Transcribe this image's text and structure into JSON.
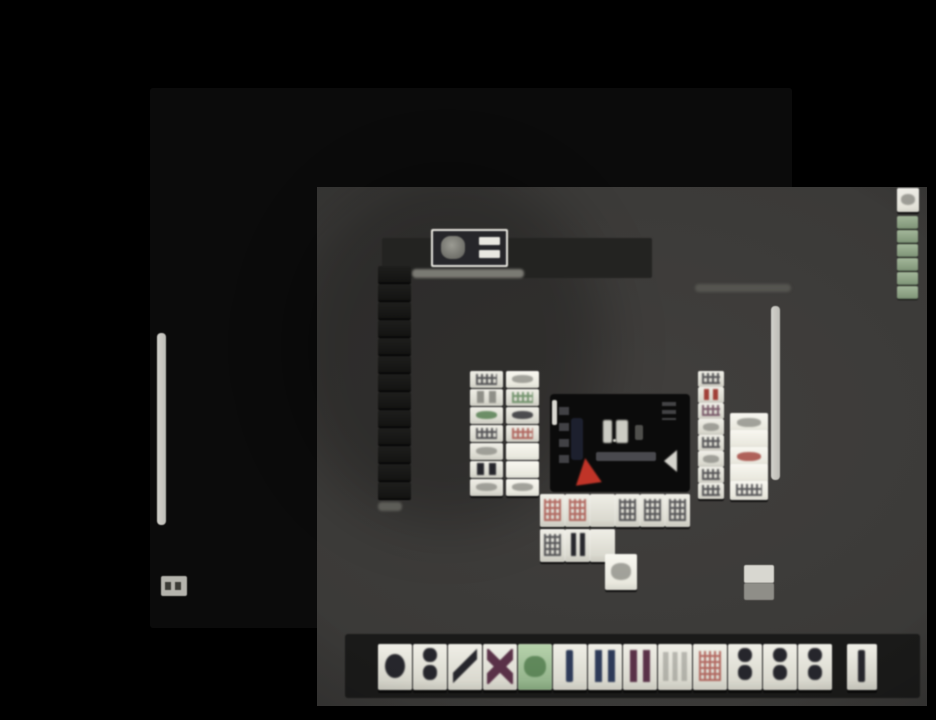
{
  "palette": {
    "black": "#000000",
    "frame": "#0b0b0b",
    "table": "#3b3a38",
    "band": "#232321",
    "white_ui": "#d9d8d1",
    "scrollbar": "#c9c8c2",
    "caption_smudge": "#98978f",
    "info_smudge": "#5c5c56",
    "red_marker": "#c03428",
    "glyph_dark": "#26262c",
    "glyph_gray": "#8f8f88",
    "glyph_red": "#a03f38",
    "glyph_green": "#4f7a4b",
    "glyph_navy": "#2d3a58",
    "glyph_maroon": "#5a3148",
    "green_tile_face": "#a4c49a",
    "wall_tile_back": "#161614"
  },
  "board": {
    "hand": {
      "tiles": [
        {
          "glyph": "circle",
          "color": "glyph_dark"
        },
        {
          "glyph": "dots2",
          "color": "glyph_dark"
        },
        {
          "glyph": "diag",
          "color": "glyph_dark"
        },
        {
          "glyph": "cross",
          "color": "glyph_maroon"
        },
        {
          "face": "green",
          "glyph": "smudge",
          "color": "glyph_green"
        },
        {
          "glyph": "bar",
          "color": "glyph_navy"
        },
        {
          "glyph": "bars2",
          "color": "glyph_navy"
        },
        {
          "glyph": "bars2",
          "color": "glyph_maroon"
        },
        {
          "glyph": "bars3",
          "color": "glyph_gray"
        },
        {
          "glyph": "cluster",
          "color": "glyph_red"
        },
        {
          "glyph": "dots2",
          "color": "glyph_dark"
        },
        {
          "glyph": "dots2",
          "color": "glyph_dark"
        },
        {
          "glyph": "dots2",
          "color": "glyph_dark"
        }
      ],
      "drawn": [
        {
          "glyph": "bar",
          "color": "glyph_dark"
        }
      ]
    },
    "discards": {
      "left_col_a": [
        {
          "glyph": "cluster",
          "color": "glyph_dark"
        },
        {
          "glyph": "bars2",
          "color": "glyph_gray"
        },
        {
          "glyph": "smudge",
          "color": "glyph_green"
        },
        {
          "glyph": "cluster",
          "color": "glyph_dark"
        },
        {
          "glyph": "smudge",
          "color": "glyph_gray"
        },
        {
          "glyph": "bars2",
          "color": "glyph_dark"
        },
        {
          "glyph": "smudge",
          "color": "glyph_gray"
        }
      ],
      "left_col_b": [
        {
          "face": "bright",
          "glyph": "smudge",
          "color": "glyph_gray"
        },
        {
          "glyph": "cluster",
          "color": "glyph_green"
        },
        {
          "glyph": "smudge",
          "color": "glyph_dark"
        },
        {
          "glyph": "cluster",
          "color": "glyph_red"
        },
        {
          "face": "bright",
          "glyph": "blank"
        },
        {
          "face": "bright",
          "glyph": "blank"
        },
        {
          "face": "bright",
          "glyph": "smudge",
          "color": "glyph_gray"
        }
      ],
      "right_col_a": [
        {
          "glyph": "cluster",
          "color": "glyph_dark"
        },
        {
          "glyph": "bars2",
          "color": "glyph_red"
        },
        {
          "glyph": "cluster",
          "color": "glyph_maroon"
        },
        {
          "glyph": "smudge",
          "color": "glyph_gray"
        },
        {
          "glyph": "cluster",
          "color": "glyph_dark"
        },
        {
          "glyph": "smudge",
          "color": "glyph_gray"
        },
        {
          "glyph": "cluster",
          "color": "glyph_dark"
        },
        {
          "glyph": "cluster",
          "color": "glyph_dark"
        }
      ],
      "right_col_b": [
        {
          "face": "bright",
          "glyph": "smudge",
          "color": "glyph_gray"
        },
        {
          "face": "bright",
          "glyph": "blank"
        },
        {
          "face": "bright",
          "glyph": "smudge",
          "color": "glyph_red"
        },
        {
          "face": "bright",
          "glyph": "blank"
        },
        {
          "face": "bright",
          "glyph": "cluster",
          "color": "glyph_dark"
        }
      ],
      "bottom_row_1": [
        {
          "glyph": "cluster",
          "color": "glyph_red"
        },
        {
          "glyph": "cluster",
          "color": "glyph_red"
        },
        {
          "glyph": "blank"
        },
        {
          "glyph": "cluster",
          "color": "glyph_dark"
        },
        {
          "glyph": "cluster",
          "color": "glyph_dark"
        },
        {
          "glyph": "cluster",
          "color": "glyph_dark"
        }
      ],
      "bottom_row_2": [
        {
          "glyph": "cluster",
          "color": "glyph_dark"
        },
        {
          "glyph": "bars2",
          "color": "glyph_dark"
        },
        {
          "glyph": "blank"
        }
      ],
      "bottom_row_3": [
        {
          "face": "bright",
          "glyph": "smudge",
          "color": "glyph_gray"
        }
      ]
    },
    "walls": {
      "left_column": [
        {
          "face": "dark",
          "glyph": "blank"
        },
        {
          "face": "dark",
          "glyph": "blank"
        },
        {
          "face": "dark",
          "glyph": "blank"
        },
        {
          "face": "dark",
          "glyph": "blank"
        },
        {
          "face": "dark",
          "glyph": "blank"
        },
        {
          "face": "dark",
          "glyph": "blank"
        },
        {
          "face": "dark",
          "glyph": "blank"
        },
        {
          "face": "dark",
          "glyph": "blank"
        },
        {
          "face": "dark",
          "glyph": "blank"
        },
        {
          "face": "dark",
          "glyph": "blank"
        },
        {
          "face": "dark",
          "glyph": "blank"
        },
        {
          "face": "dark",
          "glyph": "blank"
        },
        {
          "face": "dark",
          "glyph": "blank"
        }
      ],
      "dead_wall_top": [
        {
          "face": "bright",
          "glyph": "smudge",
          "color": "glyph_gray"
        }
      ],
      "dead_wall_stack": [
        {
          "face": "wallgreen",
          "glyph": "blank"
        },
        {
          "face": "wallgreen",
          "glyph": "blank"
        },
        {
          "face": "wallgreen",
          "glyph": "blank"
        },
        {
          "face": "wallgreen",
          "glyph": "blank"
        },
        {
          "face": "wallgreen",
          "glyph": "blank"
        },
        {
          "face": "wallgreen",
          "glyph": "blank"
        }
      ]
    }
  }
}
